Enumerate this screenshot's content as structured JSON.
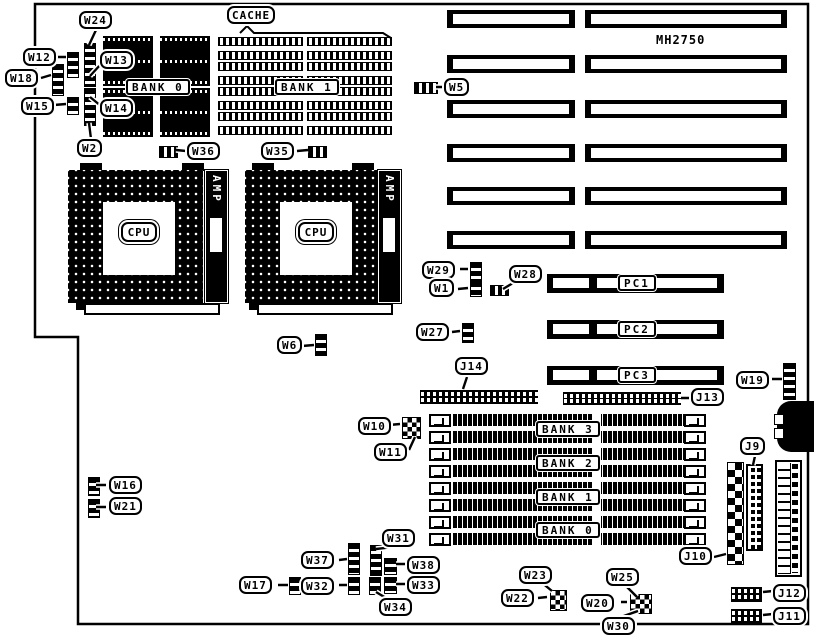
{
  "board": {
    "model": "MH2750"
  },
  "memory": {
    "cache_title": "CACHE",
    "cache_banks": [
      "BANK 0",
      "BANK 1"
    ],
    "simm_banks": [
      "BANK 3",
      "BANK 2",
      "BANK 1",
      "BANK 0"
    ]
  },
  "cpu": {
    "socket_label": "CPU",
    "connector_label": "AMP"
  },
  "slots": {
    "pc": [
      "PC1",
      "PC2",
      "PC3"
    ]
  },
  "connectors": {
    "j9": "J9",
    "j10": "J10",
    "j11": "J11",
    "j12": "J12",
    "j13": "J13",
    "j14": "J14"
  },
  "jumpers": {
    "w1": "W1",
    "w2": "W2",
    "w5": "W5",
    "w6": "W6",
    "w10": "W10",
    "w11": "W11",
    "w12": "W12",
    "w13": "W13",
    "w14": "W14",
    "w15": "W15",
    "w16": "W16",
    "w17": "W17",
    "w18": "W18",
    "w19": "W19",
    "w20": "W20",
    "w21": "W21",
    "w22": "W22",
    "w23": "W23",
    "w24": "W24",
    "w25": "W25",
    "w27": "W27",
    "w28": "W28",
    "w29": "W29",
    "w30": "W30",
    "w31": "W31",
    "w32": "W32",
    "w33": "W33",
    "w34": "W34",
    "w35": "W35",
    "w36": "W36",
    "w37": "W37",
    "w38": "W38"
  }
}
